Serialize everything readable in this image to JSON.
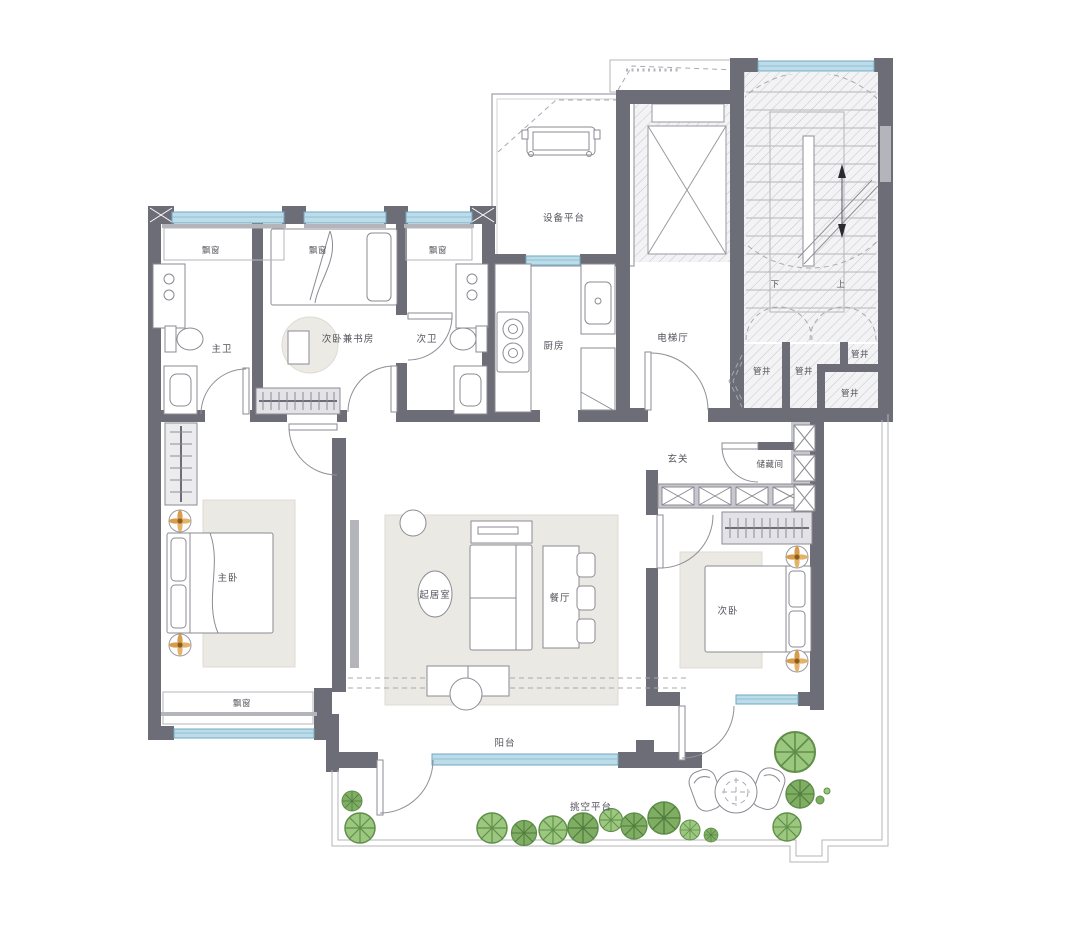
{
  "rooms": {
    "master_bedroom": "主卧",
    "second_bedroom": "次卧",
    "second_bedroom_study": "次卧兼书房",
    "living_room": "起居室",
    "dining_room": "餐厅",
    "kitchen": "厨房",
    "master_bathroom": "主卫",
    "second_bathroom": "次卫",
    "foyer": "玄关",
    "storage_room": "储藏间",
    "elevator_hall": "电梯厅",
    "equipment_platform": "设备平台",
    "balcony": "阳台",
    "cantilevered_platform": "挑空平台",
    "bay_window": "飘窗",
    "pipe_shaft": "管井",
    "stairs_up": "上",
    "stairs_down": "下"
  },
  "colors": {
    "wall": "#6d6d77",
    "wall_light": "#b4b4bb",
    "window_blue": "#bcdcea",
    "hatch_line": "#c6c6cc",
    "rug": "#ebe9e3",
    "plant_green": "#93c47d",
    "downlight_gold": "#d89c4a",
    "label_text": "#53535b"
  }
}
